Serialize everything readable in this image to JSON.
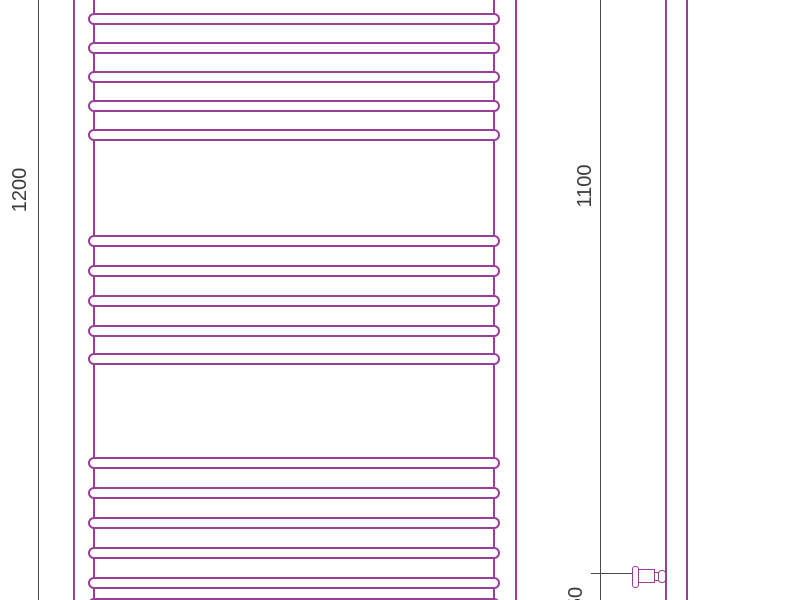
{
  "colors": {
    "outline": "#9b3e99",
    "dimension_line": "#4a4a4a",
    "label_text": "#3a3a3a",
    "background": "#ffffff"
  },
  "dimension_labels": {
    "overall_height": "1200",
    "axis_height": "1100",
    "bottom_offset": "50"
  },
  "drawing_data": {
    "type": "technical-drawing",
    "front_view": {
      "rung_x": 88,
      "rung_width": 412,
      "rung_height": 12,
      "rung_groups": [
        {
          "tops": [
            13,
            42,
            71,
            100,
            129
          ]
        },
        {
          "tops": [
            235,
            265,
            295,
            325,
            353
          ]
        },
        {
          "tops": [
            457,
            487,
            517,
            547,
            577,
            598
          ]
        }
      ]
    }
  }
}
